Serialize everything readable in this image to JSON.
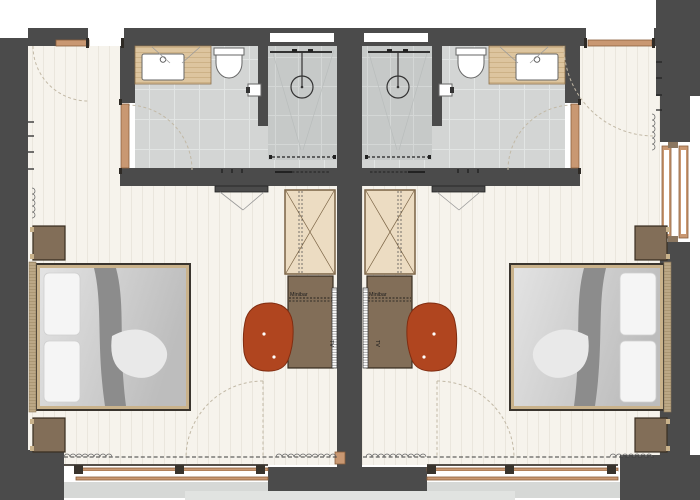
{
  "rooms": [
    {
      "side": "left",
      "minibar_label": "Minibar",
      "tv_label": "TV"
    },
    {
      "side": "right",
      "minibar_label": "Minibar",
      "tv_label": "TV"
    }
  ],
  "colors": {
    "wall": "#4b4b4b",
    "bathFloor": "#d3d5d4",
    "showerFloor": "#c6c9c8",
    "floorCream": "#f6f3ec",
    "plankLine": "#eae6dd",
    "counterWood": "#ddc59f",
    "counterLine": "#c3a677",
    "furnWood": "#8a7660",
    "furnWoodLine": "#695641",
    "wardrobe": "#ecdcc2",
    "wardrobeLine": "#7a6344",
    "chair": "#b0451f",
    "chairLine": "#802d11",
    "doorFrame": "#c99872",
    "doorFrameDark": "#8a5f3c",
    "bedFrameTan": "#c9b28b",
    "bedDark": "#3a352e",
    "pillow": "#f5f5f5",
    "duvetLight": "#e3e3e3",
    "duvetDark": "#bdbdbd",
    "runner": "#8c8c8c",
    "robe": "#e9e9e9",
    "headboard": "#bca886",
    "terrace": "#d6d8d6",
    "terraceLight": "#e1e3e1",
    "arc": "#c2b9a6",
    "dashDark": "#3c3c3c"
  }
}
